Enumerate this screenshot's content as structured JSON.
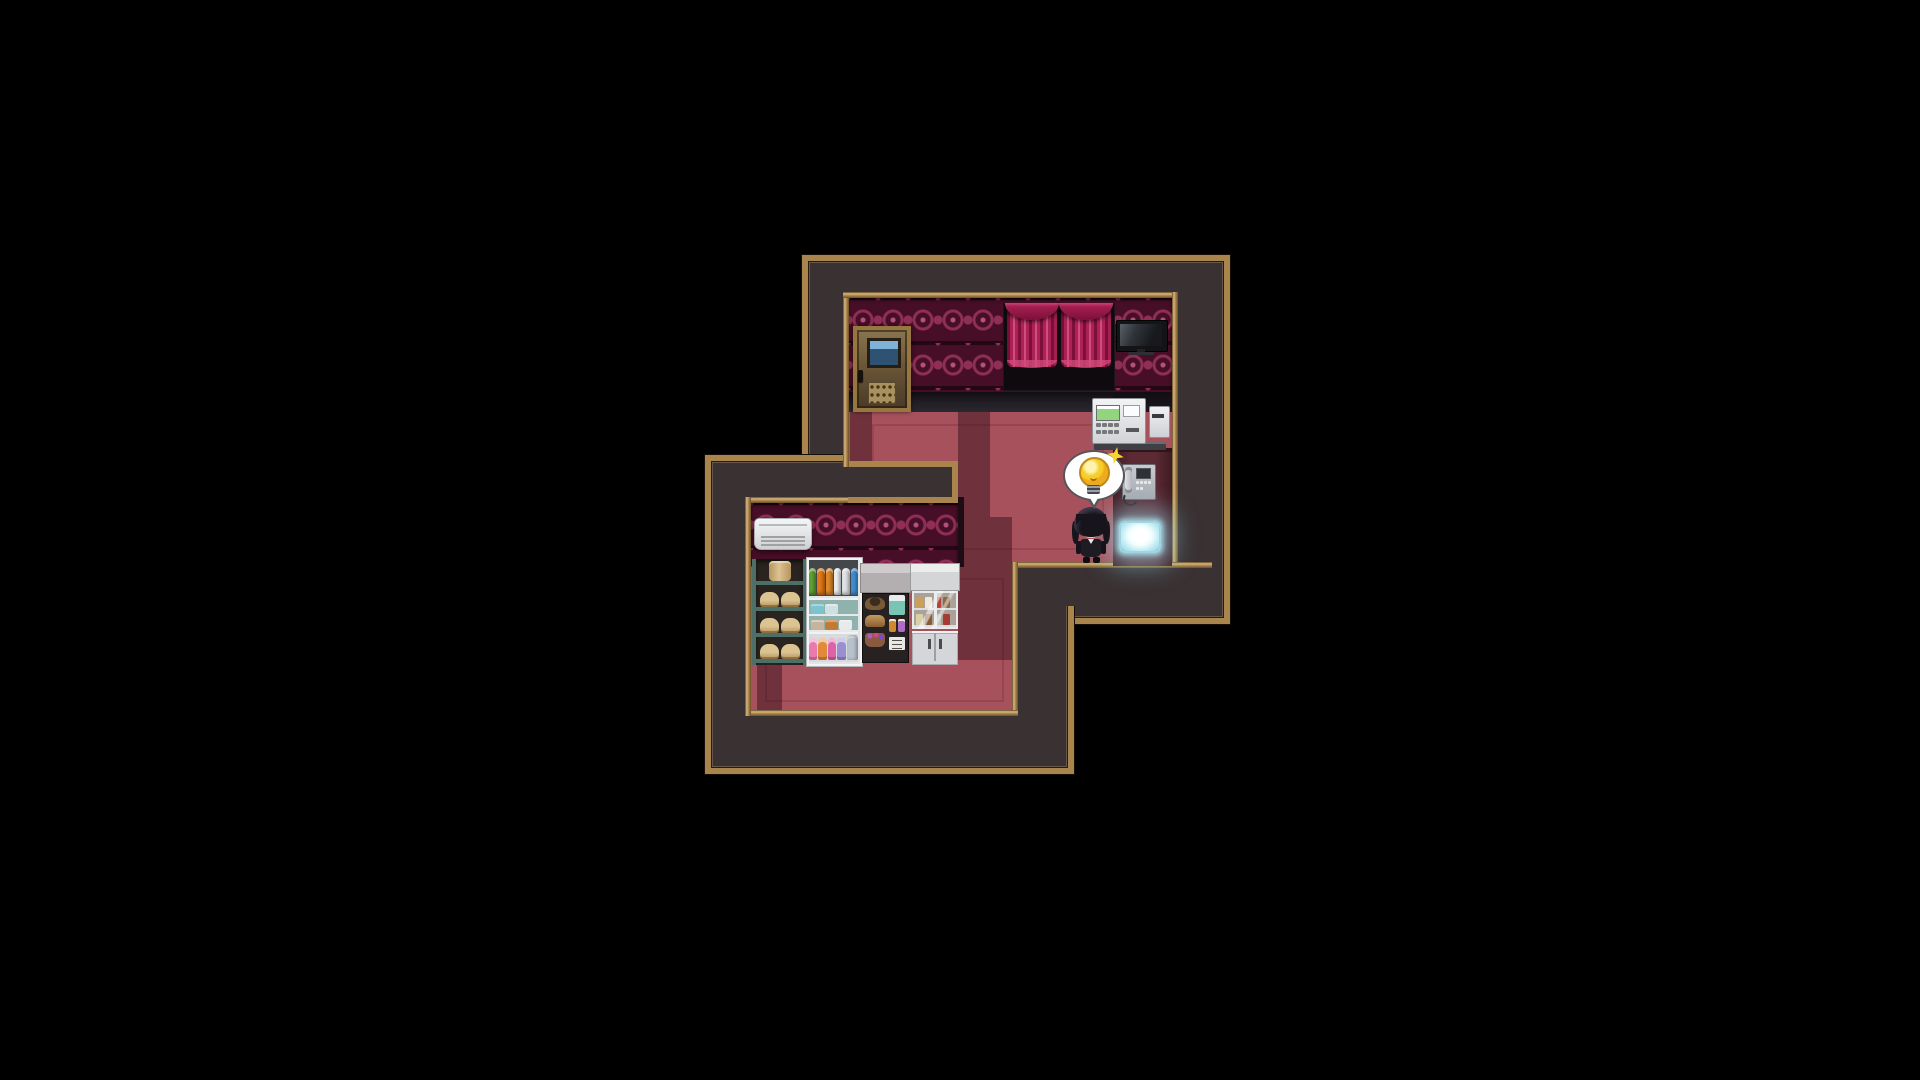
{
  "app": {
    "name": "rpg-maker-style-game",
    "view": "interior-map-screen",
    "hud_text": []
  },
  "palette": {
    "bg": "#000000",
    "frame": "#a9854d",
    "frame_light": "#d9b77c",
    "frame_dark": "#6b5128",
    "wall": "#3a3132",
    "wallpaper": "#470e27",
    "motif": "#8f2f55",
    "motif_light": "#b5527b",
    "floor": "#a7515c",
    "floor_line": "#833b47",
    "shadow": "rgba(33,6,17,0.42)",
    "strip": "#5b2b34",
    "strip_edge": "#3f1b23",
    "window": "#0e0a0e",
    "curtain_dark": "#7c1038",
    "curtain_mid": "#ad2256",
    "curtain_light": "#d14e7c",
    "door_frame": "#97773f",
    "door_top": "#8a7550",
    "door_bottom": "#4a3b27",
    "door_window_top": "#7fb2d8",
    "door_window": "#2e5372",
    "door_sign": "#a8915f",
    "tv_body": "#141417",
    "tv_screen_hi": "#5a6068",
    "tv_screen_lo": "#17191c",
    "machine_screen": "#93d47e",
    "machine_base": "#3f4044",
    "phone_screen": "#2e3237",
    "glow_core": "#f0feff",
    "glow_mid": "#a6dfea",
    "glow_halo": "rgba(150,225,240,0.55)",
    "ac_vent": "#9fa1a4",
    "shelf_teal": "#4e6f68",
    "shelf_bg": "#29241f",
    "bread_hi": "#dbc392",
    "bread_lo": "#b6945e",
    "cooler_back": "#8fb2ad",
    "goods_top_hi": "#d0cccd",
    "goods_top_lo": "#b3aeb0",
    "goods_body": "#272221",
    "goods_hat": "#7a5a36",
    "goods_basket": "#8a5a40",
    "goods_tall": "#7ac4b4",
    "goods_jar1": "#d08a2e",
    "goods_jar2": "#b06ac8",
    "goods_sign": "#e8e8e6",
    "cabinet_top": "#d4d5d7",
    "cabinet_glass": "#aaa198",
    "cabinet_lower": "#d5d6d9",
    "hair": "#17151b",
    "face": "#f1d5bb",
    "eye": "#2c3c55",
    "suit": "#1e1c22",
    "bubble": "#ffffff",
    "bubble_outline": "#56565a",
    "bulb": "#f7cd27",
    "bulb_edge": "#c08a18",
    "bulb_base": "#9aa0a8",
    "sparkle": "#f8d42e"
  },
  "rooms": [
    {
      "id": "upper-lounge",
      "wall_style": "dark-red damask wallpaper over black baseboard",
      "floor_style": "red carpet with darker border lines",
      "objects": [
        "wooden-door",
        "curtained-window",
        "wall-tv",
        "atm-machine",
        "wall-phone",
        "glowing-panel"
      ]
    },
    {
      "id": "lower-shop-room",
      "wall_style": "dark-red damask wallpaper",
      "floor_style": "red carpet with darker border lines",
      "objects": [
        "air-conditioner",
        "bread-shelf",
        "drink-cooler",
        "goods-shelf",
        "storage-cabinet"
      ]
    }
  ],
  "character": {
    "id": "player-character",
    "appearance": "black-haired chibi in black suit",
    "state": "standing near bottom wall of upper room",
    "emote_balloon": "idea-lightbulb"
  },
  "furniture": {
    "drink_cooler": {
      "top_bottles": [
        "#5fa232",
        "#e07818",
        "#e08a2a",
        "#eceef0",
        "#dfe2e5",
        "#3f8fd2"
      ],
      "middle_shelf_1": [
        "#79c4cf",
        "#cfe0e2"
      ],
      "middle_shelf_2": [
        "#c8b49a",
        "#c27a35",
        "#e8e9ea"
      ],
      "bottom_bottles": [
        "#e87aae",
        "#e08a3a",
        "#dd62a8",
        "#9a8fd0"
      ],
      "jug": "#b9c2cc"
    },
    "bread_shelf": {
      "rows": [
        [
          "barrel"
        ],
        [
          "loaf",
          "loaf"
        ],
        [
          "loaf",
          "loaf"
        ],
        [
          "loaf",
          "loaf"
        ]
      ]
    },
    "storage_cabinet": {
      "shelf_rows": [
        [
          "#c8a05a",
          "#efe9dd",
          "#b4443a",
          "#8a6a42"
        ],
        [
          "#d9cfa8",
          "#8a5a36",
          "#c7c2ba",
          "#a43c34"
        ]
      ]
    },
    "wall_phone": {
      "keypad_buttons": 6
    },
    "atm": {
      "keypad_buttons": 8
    }
  }
}
